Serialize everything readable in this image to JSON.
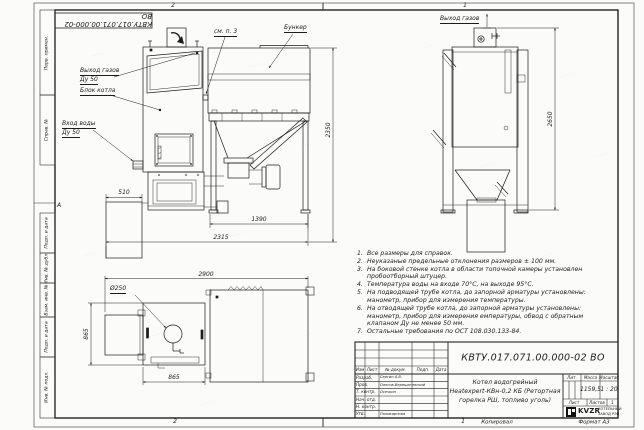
{
  "watermark": {
    "glyph": "·······"
  },
  "stamp": {
    "doc_number": "КВТУ.017.071.00.000-02 ВО"
  },
  "frame": {
    "zone_top_left": "2",
    "zone_top_right": "1",
    "zone_bottom_left": "2",
    "zone_bottom_right": "1",
    "zone_letter": "А",
    "copied_label": "Копировал",
    "format_label": "Формат А3",
    "margin_labels": [
      "Перв. примен.",
      "Справ. №",
      "Подп. и дата",
      "Инв. № дубл.",
      "Взам. инв. №",
      "Подп. и дата",
      "Инв. № подл."
    ]
  },
  "views": {
    "front": {
      "labels": {
        "gas_outlet_line1": "Выход газов",
        "gas_outlet_line2": "Ду 50",
        "boiler_block": "Блок котла",
        "water_inlet_line1": "Вход воды",
        "water_inlet_line2": "Ду 50",
        "see_note": "см. п. 3",
        "hopper": "Бункер"
      },
      "dims": {
        "width_left_box": "510",
        "height": "2350",
        "hopper_width": "1390",
        "total_width": "2315"
      }
    },
    "side": {
      "labels": {
        "gas_outlet": "Выход газов"
      },
      "dims": {
        "height": "2650"
      }
    },
    "plan": {
      "labels": {
        "diameter": "Ø250"
      },
      "dims": {
        "total_width": "2900",
        "depth": "865",
        "boiler_width": "865"
      }
    }
  },
  "notes": {
    "items": [
      {
        "n": "1.",
        "text": "Все размеры для справок."
      },
      {
        "n": "2.",
        "text": "Неуказаные предельные отклонения размеров ± 100 мм."
      },
      {
        "n": "3.",
        "text": "На боковой стенке котла в области топочной камеры установлен пробоотборный штуцер."
      },
      {
        "n": "4.",
        "text": "Температура воды на входе 70°С, на выходе 95°С."
      },
      {
        "n": "5.",
        "text": "На подводящей трубе котла, до запорной арматуры установлены: манометр, прибор для измерения температуры."
      },
      {
        "n": "6.",
        "text": "На отводящей трубе котла, до запорной арматуры установлены: манометр, прибор для измерения емпературы, обвод с обратным клапаном Ду не менее 50 мм."
      },
      {
        "n": "7.",
        "text": "Остальные требования по ОСТ 108.030.133-84."
      }
    ]
  },
  "title_block": {
    "doc_number": "КВТУ.017.071.00.000-02 ВО",
    "product_line1": "Котел водогрейный",
    "product_line2": "Heatexpert-КВн-0,2 КБ (Ретортная",
    "product_line3": "горелка РШ, топливо уголь)",
    "cols": {
      "izm": "Изм",
      "list": "Лист",
      "doc": "№ докум.",
      "podp": "Подп.",
      "data": "Дата"
    },
    "rows": [
      {
        "role": "Разраб.",
        "name": "Сергин А.В."
      },
      {
        "role": "Пров.",
        "name": "Олесов-Верещагинский"
      },
      {
        "role": "Т. контр.",
        "name": "Осечкин"
      },
      {
        "role": "Нач. отд.",
        "name": ""
      },
      {
        "role": "Н. контр.",
        "name": ""
      },
      {
        "role": "Утв.",
        "name": "Поликарпова"
      }
    ],
    "lit_label": "Лит.",
    "mass_label": "Масса",
    "scale_label": "Масштаб",
    "mass_value": "1159,5",
    "scale_value": "1 : 20",
    "sheet_label": "Лист",
    "sheets_label": "Листов",
    "sheets_value": "1",
    "logo_text": "KVZR",
    "org_line1": "КОТЕЛЬНЫЙ",
    "org_line2": "ЗАВОД РЭП"
  }
}
